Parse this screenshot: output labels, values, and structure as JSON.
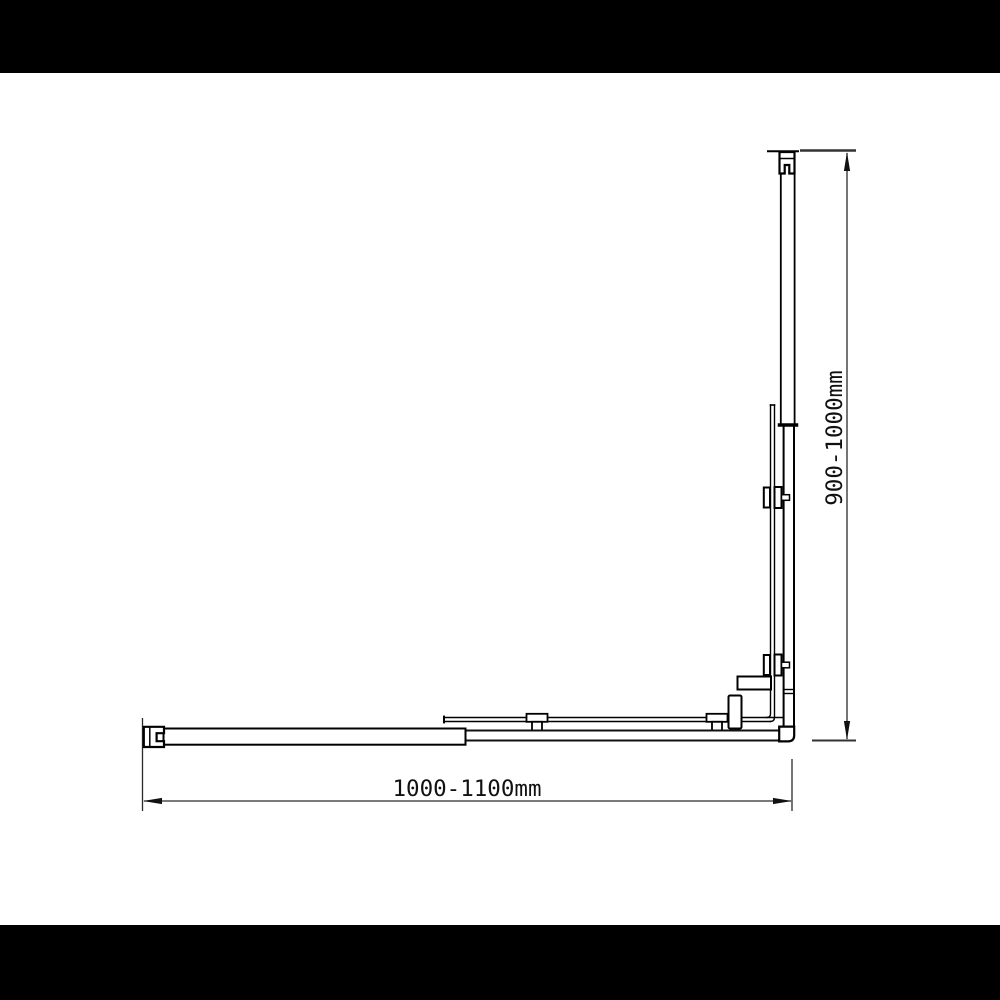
{
  "drawing": {
    "subject": "Corner shower screen frame - dimensioned elevation line drawing",
    "width_dimension_label": "1000-1100mm",
    "height_dimension_label": "900-1000mm"
  },
  "colors": {
    "background": "#ffffff",
    "letterbox": "#000000",
    "profile_line": "#000000",
    "dimension_line": "#2b2b2b",
    "label_text": "#111111"
  }
}
